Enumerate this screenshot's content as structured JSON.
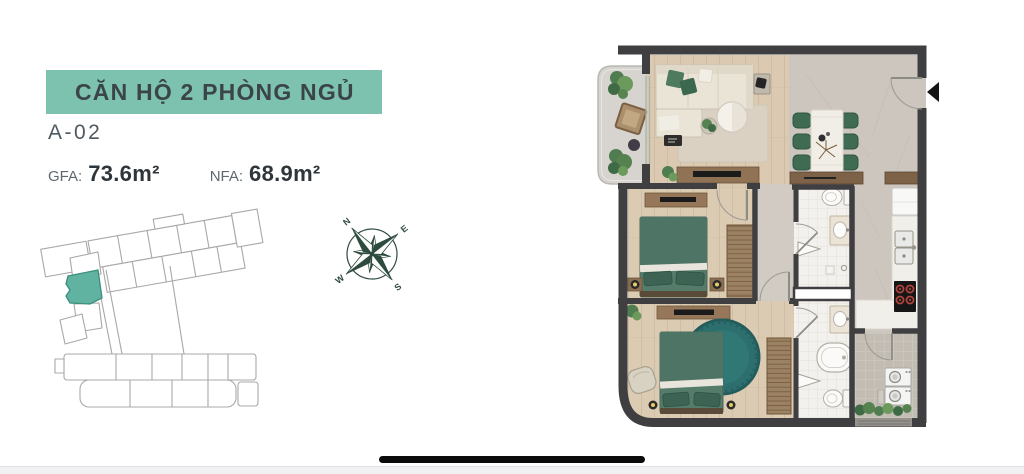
{
  "header": {
    "title": "CĂN HỘ 2 PHÒNG NGỦ",
    "unit_code": "A-02",
    "gfa_label": "GFA:",
    "gfa_value": "73.6m²",
    "nfa_label": "NFA:",
    "nfa_value": "68.9m²"
  },
  "compass": {
    "n": "N",
    "e": "E",
    "s": "S",
    "w": "W"
  },
  "icons": {
    "compass": "compass-rose-icon",
    "entrance_arrow": "entrance-arrow-icon",
    "home_indicator": "home-indicator-bar"
  },
  "colors": {
    "badge_teal": "#7CC2AE",
    "title_text": "#3B4449",
    "keyplan_outline": "#A8A8A8",
    "keyplan_highlight": "#5FB3A0",
    "compass_green": "#2E4B3F",
    "wall": "#3F3F41",
    "wood_floor": "#DBC9B1",
    "marble_floor": "#CDC6BE",
    "tile_floor": "#F3F1ED",
    "balcony_floor": "#D7D4CF",
    "sofa_beige": "#EAE4D7",
    "furniture_green": "#4E7465",
    "dining_chair_green": "#3E6B52",
    "rug_teal": "#2C6F6E",
    "cabinet_brown": "#8F7354",
    "home_indicator": "#0B0B0B"
  }
}
